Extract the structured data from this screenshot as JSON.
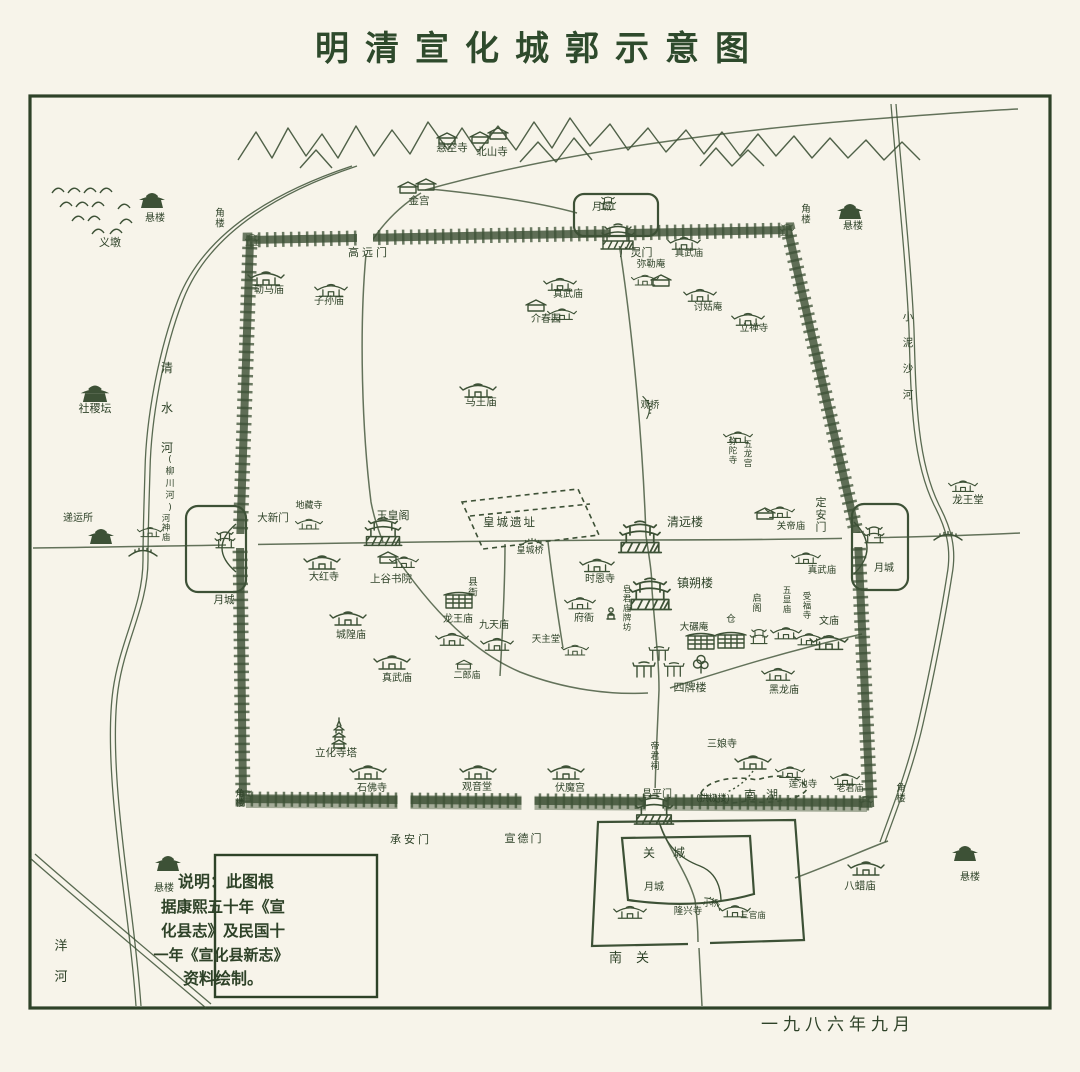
{
  "title": "明清宣化城郭示意图",
  "date": "一九八六年九月",
  "note_box": {
    "lines": [
      "说明：此图根",
      "据康熙五十年《宣",
      "化县志》及民国十",
      "一年《宣化县新志》",
      "资料绘制。"
    ]
  },
  "colors": {
    "ink": "#3d5136",
    "ink_dark": "#2e4228",
    "paper": "#f7f4ea"
  },
  "icon_names": {
    "t": "temple-icon",
    "tw": "tower-icon",
    "bt": "gate-tower-icon",
    "pg": "pagoda-icon",
    "dk": "dark-pavilion-icon",
    "h": "house-icon",
    "st": "statue-icon",
    "cp": "walled-compound-icon",
    "g": "pailou-icon",
    "br": "bridge-icon",
    "tr": "tree-icon"
  },
  "labels": [
    {
      "t": "明清宣化城郭示意图",
      "x": 540,
      "y": 60,
      "s": 34,
      "ls": 16,
      "c": "title",
      "n": "map-title"
    },
    {
      "t": "北山寺",
      "x": 492,
      "y": 155,
      "s": 10.5
    },
    {
      "t": "悬空寺",
      "x": 452,
      "y": 151,
      "s": 10.5
    },
    {
      "t": "金宫",
      "x": 419,
      "y": 204,
      "s": 10.5
    },
    {
      "t": "义墩",
      "x": 110,
      "y": 246,
      "s": 11
    },
    {
      "t": "悬楼",
      "x": 155,
      "y": 221,
      "s": 10
    },
    {
      "t": "角楼",
      "x": 220,
      "y": 216,
      "s": 9.5,
      "v": true
    },
    {
      "t": "社稷坛",
      "x": 95,
      "y": 412,
      "s": 11
    },
    {
      "t": "清水河",
      "x": 167,
      "y": 372,
      "s": 12,
      "v": true,
      "dy": 40
    },
    {
      "t": "(柳川河)",
      "x": 170,
      "y": 462,
      "s": 9,
      "v": true,
      "dy": 12
    },
    {
      "t": "递运所",
      "x": 78,
      "y": 521,
      "s": 10
    },
    {
      "t": "河神庙",
      "x": 166,
      "y": 521,
      "s": 8.5,
      "v": true
    },
    {
      "t": "月城",
      "x": 224,
      "y": 603,
      "s": 10.5
    },
    {
      "t": "洋河",
      "x": 61,
      "y": 950,
      "s": 13,
      "v": true,
      "dy": 31
    },
    {
      "t": "悬楼",
      "x": 164,
      "y": 891,
      "s": 10
    },
    {
      "t": "角楼",
      "x": 240,
      "y": 796,
      "s": 9,
      "v": true
    },
    {
      "t": "高远门",
      "x": 369,
      "y": 256,
      "s": 11,
      "ls": 3
    },
    {
      "t": "月城",
      "x": 602,
      "y": 210,
      "s": 10
    },
    {
      "t": "广灵门",
      "x": 636,
      "y": 256,
      "s": 11
    },
    {
      "t": "角楼",
      "x": 806,
      "y": 212,
      "s": 9.5,
      "v": true
    },
    {
      "t": "悬楼",
      "x": 853,
      "y": 229,
      "s": 10
    },
    {
      "t": "小泥沙河",
      "x": 908,
      "y": 320,
      "s": 10.5,
      "v": true,
      "dy": 26
    },
    {
      "t": "龙王堂",
      "x": 968,
      "y": 503,
      "s": 10.5
    },
    {
      "t": "定安门",
      "x": 821,
      "y": 506,
      "s": 11,
      "v": true
    },
    {
      "t": "月城",
      "x": 884,
      "y": 571,
      "s": 10
    },
    {
      "t": "勒马庙",
      "x": 269,
      "y": 293,
      "s": 10
    },
    {
      "t": "子孙庙",
      "x": 329,
      "y": 304,
      "s": 10
    },
    {
      "t": "真武庙",
      "x": 568,
      "y": 297,
      "s": 10
    },
    {
      "t": "介春园",
      "x": 546,
      "y": 322,
      "s": 10
    },
    {
      "t": "真武庙",
      "x": 689,
      "y": 256,
      "s": 9.5
    },
    {
      "t": "弥勒庵",
      "x": 651,
      "y": 267,
      "s": 9.5
    },
    {
      "t": "讨姑庵",
      "x": 708,
      "y": 310,
      "s": 9.5
    },
    {
      "t": "立禅寺",
      "x": 754,
      "y": 331,
      "s": 9.5
    },
    {
      "t": "马王庙",
      "x": 481,
      "y": 405,
      "s": 10.5
    },
    {
      "t": "观桥",
      "x": 650,
      "y": 408,
      "s": 9.5
    },
    {
      "t": "弥陀寺",
      "x": 733,
      "y": 444,
      "s": 8.5,
      "v": true
    },
    {
      "t": "五龙宫",
      "x": 748,
      "y": 447,
      "s": 8.5,
      "v": true
    },
    {
      "t": "大新门",
      "x": 273,
      "y": 521,
      "s": 10.5
    },
    {
      "t": "地藏寺",
      "x": 309,
      "y": 508,
      "s": 9
    },
    {
      "t": "玉皇阁",
      "x": 393,
      "y": 519,
      "s": 11
    },
    {
      "t": "皇城遗址",
      "x": 510,
      "y": 526,
      "s": 11.5,
      "ls": 2
    },
    {
      "t": "皇城桥",
      "x": 530,
      "y": 553,
      "s": 9
    },
    {
      "t": "清远楼",
      "x": 685,
      "y": 526,
      "s": 12
    },
    {
      "t": "镇朔楼",
      "x": 695,
      "y": 587,
      "s": 12
    },
    {
      "t": "时恩寺",
      "x": 600,
      "y": 582,
      "s": 10
    },
    {
      "t": "大红寺",
      "x": 324,
      "y": 580,
      "s": 10
    },
    {
      "t": "上谷书院",
      "x": 391,
      "y": 582,
      "s": 10.5
    },
    {
      "t": "县衙",
      "x": 473,
      "y": 585,
      "s": 9.5,
      "v": true
    },
    {
      "t": "龙王庙",
      "x": 458,
      "y": 622,
      "s": 10
    },
    {
      "t": "九天庙",
      "x": 494,
      "y": 628,
      "s": 10
    },
    {
      "t": "城隍庙",
      "x": 351,
      "y": 638,
      "s": 10
    },
    {
      "t": "真武庙",
      "x": 397,
      "y": 681,
      "s": 10
    },
    {
      "t": "二郎庙",
      "x": 467,
      "y": 678,
      "s": 9
    },
    {
      "t": "府衙",
      "x": 584,
      "y": 621,
      "s": 10
    },
    {
      "t": "皂君庙牌坊",
      "x": 627,
      "y": 592,
      "s": 8.5,
      "v": true
    },
    {
      "t": "天主堂",
      "x": 546,
      "y": 642,
      "s": 9.5
    },
    {
      "t": "大碾庵",
      "x": 694,
      "y": 630,
      "s": 9.5
    },
    {
      "t": "仓",
      "x": 731,
      "y": 622,
      "s": 9.5
    },
    {
      "t": "启阁",
      "x": 757,
      "y": 601,
      "s": 9,
      "v": true
    },
    {
      "t": "五显庙",
      "x": 787,
      "y": 593,
      "s": 8.5,
      "v": true
    },
    {
      "t": "受福寺",
      "x": 807,
      "y": 599,
      "s": 8.5,
      "v": true
    },
    {
      "t": "文庙",
      "x": 829,
      "y": 624,
      "s": 10
    },
    {
      "t": "四牌楼",
      "x": 690,
      "y": 691,
      "s": 11
    },
    {
      "t": "黑龙庙",
      "x": 784,
      "y": 693,
      "s": 10
    },
    {
      "t": "关帝庙",
      "x": 791,
      "y": 529,
      "s": 9.5
    },
    {
      "t": "真武庙",
      "x": 822,
      "y": 573,
      "s": 9.5
    },
    {
      "t": "三娘寺",
      "x": 722,
      "y": 747,
      "s": 10
    },
    {
      "t": "莲池寺",
      "x": 803,
      "y": 787,
      "s": 9.5
    },
    {
      "t": "南湖",
      "x": 766,
      "y": 799,
      "s": 12,
      "ls": 10
    },
    {
      "t": "老君庙",
      "x": 850,
      "y": 791,
      "s": 9
    },
    {
      "t": "帝君祠",
      "x": 655,
      "y": 749,
      "s": 9,
      "v": true
    },
    {
      "t": "昌平门",
      "x": 657,
      "y": 797,
      "s": 10
    },
    {
      "t": "(拱极楼)",
      "x": 713,
      "y": 801,
      "s": 9
    },
    {
      "t": "立化寺塔",
      "x": 336,
      "y": 756,
      "s": 10.5
    },
    {
      "t": "石佛寺",
      "x": 372,
      "y": 791,
      "s": 10
    },
    {
      "t": "观音堂",
      "x": 477,
      "y": 790,
      "s": 10
    },
    {
      "t": "伏魔宫",
      "x": 570,
      "y": 791,
      "s": 10
    },
    {
      "t": "承安门",
      "x": 411,
      "y": 843,
      "s": 11,
      "ls": 3
    },
    {
      "t": "宣德门",
      "x": 524,
      "y": 842,
      "s": 11,
      "ls": 2
    },
    {
      "t": "关城",
      "x": 673,
      "y": 857,
      "s": 12,
      "ls": 18
    },
    {
      "t": "月城",
      "x": 654,
      "y": 890,
      "s": 10
    },
    {
      "t": "隆兴寺",
      "x": 688,
      "y": 914,
      "s": 9.5
    },
    {
      "t": "小桥",
      "x": 711,
      "y": 906,
      "s": 8
    },
    {
      "t": "三官庙",
      "x": 753,
      "y": 918,
      "s": 8.5
    },
    {
      "t": "南关",
      "x": 636,
      "y": 962,
      "s": 13,
      "ls": 14
    },
    {
      "t": "八蜡庙",
      "x": 860,
      "y": 889,
      "s": 10.5
    },
    {
      "t": "角楼",
      "x": 901,
      "y": 791,
      "s": 9.5,
      "v": true
    },
    {
      "t": "悬楼",
      "x": 970,
      "y": 880,
      "s": 10
    },
    {
      "t": "一九八六年九月",
      "x": 838,
      "y": 1030,
      "s": 17,
      "ls": 5,
      "a": "s",
      "n": "map-date"
    },
    {
      "t": "说明：此图根",
      "x": 226,
      "y": 887,
      "s": 16,
      "a": "s",
      "c": "note",
      "n": "note-line"
    },
    {
      "t": "据康熙五十年《宣",
      "x": 223,
      "y": 912,
      "s": 15.5,
      "a": "s",
      "c": "note",
      "n": "note-line"
    },
    {
      "t": "化县志》及民国十",
      "x": 223,
      "y": 936,
      "s": 15.5,
      "a": "s",
      "c": "note",
      "n": "note-line"
    },
    {
      "t": "一年《宣化县新志》",
      "x": 221,
      "y": 960,
      "s": 15,
      "a": "s",
      "c": "note",
      "n": "note-line"
    },
    {
      "t": "资料绘制。",
      "x": 223,
      "y": 984,
      "s": 16,
      "a": "s",
      "c": "note",
      "n": "note-line"
    }
  ],
  "buildings": [
    {
      "s": "h",
      "x": 480,
      "y": 138
    },
    {
      "s": "h",
      "x": 498,
      "y": 134
    },
    {
      "s": "h",
      "x": 447,
      "y": 139
    },
    {
      "s": "h",
      "x": 408,
      "y": 188
    },
    {
      "s": "h",
      "x": 426,
      "y": 185
    },
    {
      "s": "dk",
      "x": 152,
      "y": 198
    },
    {
      "s": "dk",
      "x": 850,
      "y": 209
    },
    {
      "s": "dk",
      "x": 168,
      "y": 861
    },
    {
      "s": "dk",
      "x": 965,
      "y": 851
    },
    {
      "s": "dk",
      "x": 95,
      "y": 391,
      "k": 1.1
    },
    {
      "s": "dk",
      "x": 101,
      "y": 534
    },
    {
      "s": "t",
      "x": 150,
      "y": 531,
      "k": 0.7
    },
    {
      "s": "t",
      "x": 963,
      "y": 485,
      "k": 0.8
    },
    {
      "s": "t",
      "x": 266,
      "y": 277
    },
    {
      "s": "t",
      "x": 331,
      "y": 289,
      "k": 0.9
    },
    {
      "s": "t",
      "x": 560,
      "y": 283,
      "k": 0.9
    },
    {
      "s": "h",
      "x": 536,
      "y": 306
    },
    {
      "s": "t",
      "x": 562,
      "y": 313,
      "k": 0.8
    },
    {
      "s": "t",
      "x": 478,
      "y": 389
    },
    {
      "s": "t",
      "x": 645,
      "y": 279,
      "k": 0.75
    },
    {
      "s": "h",
      "x": 661,
      "y": 281
    },
    {
      "s": "t",
      "x": 684,
      "y": 242,
      "k": 0.9
    },
    {
      "s": "t",
      "x": 700,
      "y": 294,
      "k": 0.9
    },
    {
      "s": "t",
      "x": 748,
      "y": 318,
      "k": 0.9
    },
    {
      "s": "t",
      "x": 738,
      "y": 436,
      "k": 0.8
    },
    {
      "s": "t",
      "x": 309,
      "y": 523,
      "k": 0.75
    },
    {
      "s": "bt",
      "x": 383,
      "y": 530,
      "k": 1.1
    },
    {
      "s": "t",
      "x": 322,
      "y": 561
    },
    {
      "s": "h",
      "x": 388,
      "y": 558
    },
    {
      "s": "t",
      "x": 404,
      "y": 561,
      "k": 0.8
    },
    {
      "s": "cp",
      "x": 459,
      "y": 601
    },
    {
      "s": "t",
      "x": 452,
      "y": 638,
      "k": 0.9
    },
    {
      "s": "t",
      "x": 497,
      "y": 643,
      "k": 0.9
    },
    {
      "s": "t",
      "x": 348,
      "y": 617
    },
    {
      "s": "t",
      "x": 392,
      "y": 661
    },
    {
      "s": "h",
      "x": 464,
      "y": 665,
      "k": 0.8
    },
    {
      "s": "t",
      "x": 597,
      "y": 564,
      "k": 0.95
    },
    {
      "s": "bt",
      "x": 640,
      "y": 535,
      "k": 1.25
    },
    {
      "s": "bt",
      "x": 650,
      "y": 592,
      "k": 1.25
    },
    {
      "s": "t",
      "x": 580,
      "y": 602,
      "k": 0.85
    },
    {
      "s": "st",
      "x": 611,
      "y": 613
    },
    {
      "s": "t",
      "x": 575,
      "y": 649,
      "k": 0.75
    },
    {
      "s": "cp",
      "x": 701,
      "y": 642
    },
    {
      "s": "cp",
      "x": 731,
      "y": 641
    },
    {
      "s": "tw",
      "x": 759,
      "y": 634,
      "k": 0.8
    },
    {
      "s": "t",
      "x": 786,
      "y": 632,
      "k": 0.85
    },
    {
      "s": "t",
      "x": 809,
      "y": 638,
      "k": 0.85
    },
    {
      "s": "t",
      "x": 829,
      "y": 641,
      "k": 1.05
    },
    {
      "s": "g",
      "x": 644,
      "y": 669
    },
    {
      "s": "g",
      "x": 659,
      "y": 653,
      "k": 0.9
    },
    {
      "s": "g",
      "x": 674,
      "y": 669,
      "k": 0.9
    },
    {
      "s": "tr",
      "x": 701,
      "y": 664
    },
    {
      "s": "t",
      "x": 778,
      "y": 673,
      "k": 0.9
    },
    {
      "s": "t",
      "x": 780,
      "y": 511,
      "k": 0.8
    },
    {
      "s": "h",
      "x": 765,
      "y": 514
    },
    {
      "s": "t",
      "x": 806,
      "y": 557,
      "k": 0.8
    },
    {
      "s": "t",
      "x": 753,
      "y": 761
    },
    {
      "s": "t",
      "x": 790,
      "y": 771,
      "k": 0.8
    },
    {
      "s": "t",
      "x": 845,
      "y": 778,
      "k": 0.8
    },
    {
      "s": "t",
      "x": 368,
      "y": 771
    },
    {
      "s": "t",
      "x": 478,
      "y": 771
    },
    {
      "s": "t",
      "x": 566,
      "y": 771
    },
    {
      "s": "pg",
      "x": 339,
      "y": 734
    },
    {
      "s": "t",
      "x": 630,
      "y": 911,
      "k": 0.9
    },
    {
      "s": "t",
      "x": 735,
      "y": 910,
      "k": 0.85
    },
    {
      "s": "t",
      "x": 866,
      "y": 867
    },
    {
      "s": "tw",
      "x": 608,
      "y": 201,
      "k": 0.7
    },
    {
      "s": "bt",
      "x": 618,
      "y": 235
    },
    {
      "s": "tw",
      "x": 225,
      "y": 537,
      "k": 0.9
    },
    {
      "s": "tw",
      "x": 874,
      "y": 532,
      "k": 0.9
    },
    {
      "s": "bt",
      "x": 654,
      "y": 808,
      "k": 1.15
    },
    {
      "s": "tw",
      "x": 252,
      "y": 238,
      "k": 0.6
    },
    {
      "s": "tw",
      "x": 787,
      "y": 228,
      "k": 0.6
    },
    {
      "s": "tw",
      "x": 866,
      "y": 800,
      "k": 0.6
    },
    {
      "s": "tw",
      "x": 246,
      "y": 794,
      "k": 0.6
    },
    {
      "s": "br",
      "x": 143,
      "y": 552
    },
    {
      "s": "br",
      "x": 948,
      "y": 536
    },
    {
      "s": "br",
      "x": 532,
      "y": 542,
      "k": 0.8
    },
    {
      "s": "br",
      "x": 648,
      "y": 407,
      "k": 0.8,
      "r": 80
    },
    {
      "s": "br",
      "x": 714,
      "y": 902,
      "k": 0.7,
      "r": 40
    }
  ]
}
